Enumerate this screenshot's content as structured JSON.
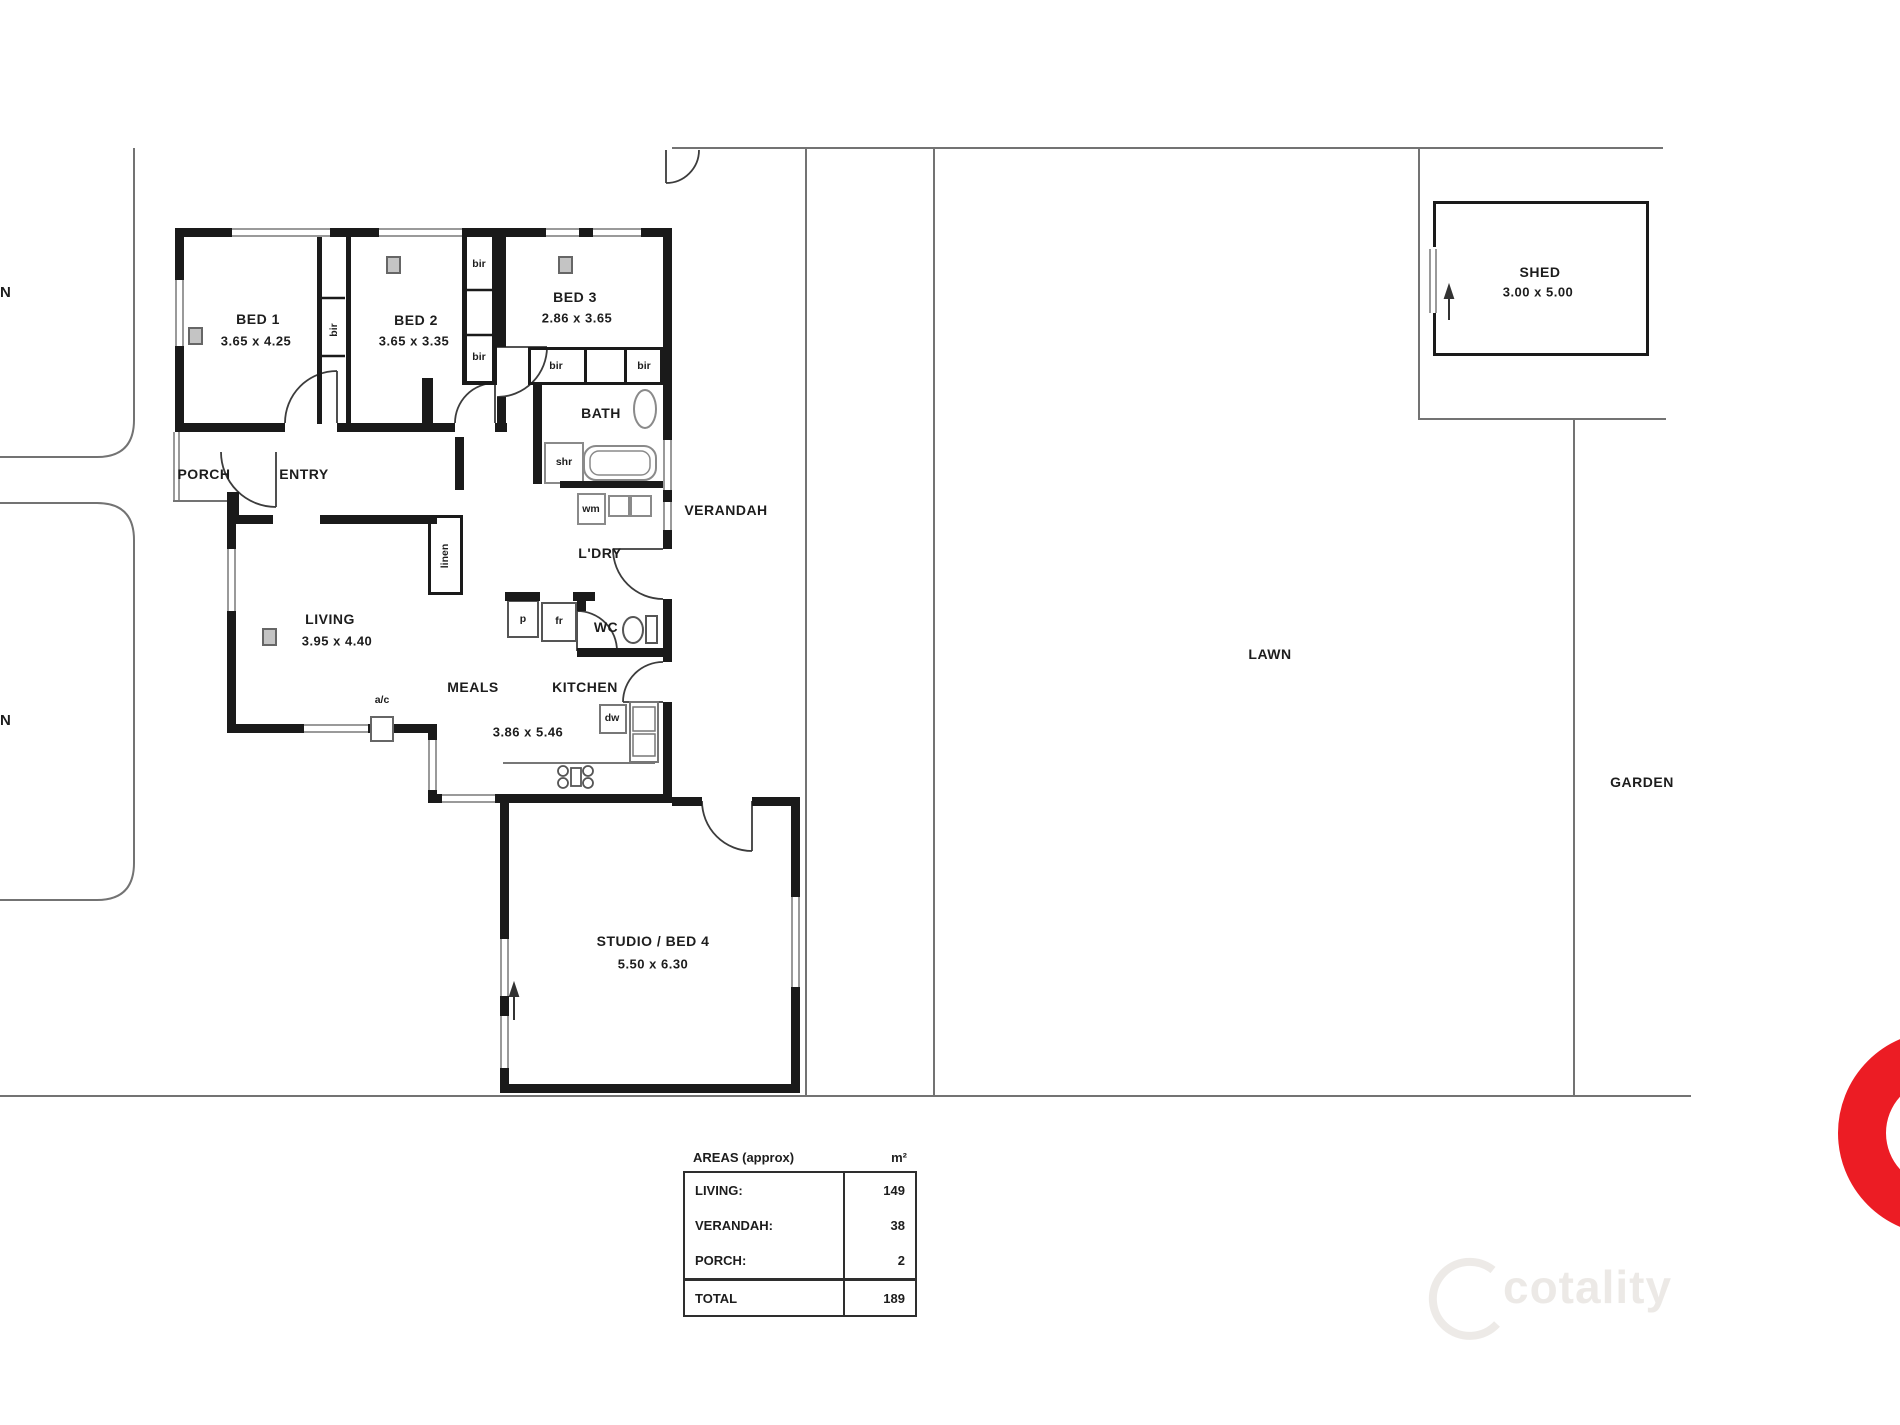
{
  "rooms": {
    "bed1": {
      "name": "BED 1",
      "dims": "3.65 x 4.25"
    },
    "bed2": {
      "name": "BED 2",
      "dims": "3.65 x 3.35"
    },
    "bed3": {
      "name": "BED 3",
      "dims": "2.86 x 3.65"
    },
    "living": {
      "name": "LIVING",
      "dims": "3.95 x 4.40"
    },
    "meals": {
      "name": "MEALS"
    },
    "kitchen": {
      "name": "KITCHEN"
    },
    "meals_kitchen_dims": "3.86 x 5.46",
    "bath": {
      "name": "BATH"
    },
    "ldry": {
      "name": "L'DRY"
    },
    "wc": {
      "name": "WC"
    },
    "entry": {
      "name": "ENTRY"
    },
    "porch": {
      "name": "PORCH"
    },
    "verandah": {
      "name": "VERANDAH"
    },
    "studio": {
      "name": "STUDIO / BED 4",
      "dims": "5.50 x 6.30"
    },
    "shed": {
      "name": "SHED",
      "dims": "3.00 x 5.00"
    },
    "lawn": {
      "name": "LAWN"
    },
    "garden": {
      "name": "GARDEN"
    }
  },
  "fixtures": {
    "bir": "bir",
    "linen": "linen",
    "shower": "shr",
    "washing_machine": "wm",
    "pantry": "p",
    "fridge": "fr",
    "dishwasher": "dw",
    "air_conditioner": "a/c",
    "neighbor_label": "N"
  },
  "areas_table": {
    "title": "AREAS (approx)",
    "unit": "m²",
    "rows": [
      {
        "label": "LIVING:",
        "value": "149"
      },
      {
        "label": "VERANDAH:",
        "value": "38"
      },
      {
        "label": "PORCH:",
        "value": "2"
      }
    ],
    "total_label": "TOTAL",
    "total_value": "189"
  },
  "watermark": "cotality",
  "colors": {
    "wall": "#1a1a1a",
    "boundary_line": "#737373",
    "window": "#9a9a9a",
    "accent_red": "#ec1c24"
  }
}
